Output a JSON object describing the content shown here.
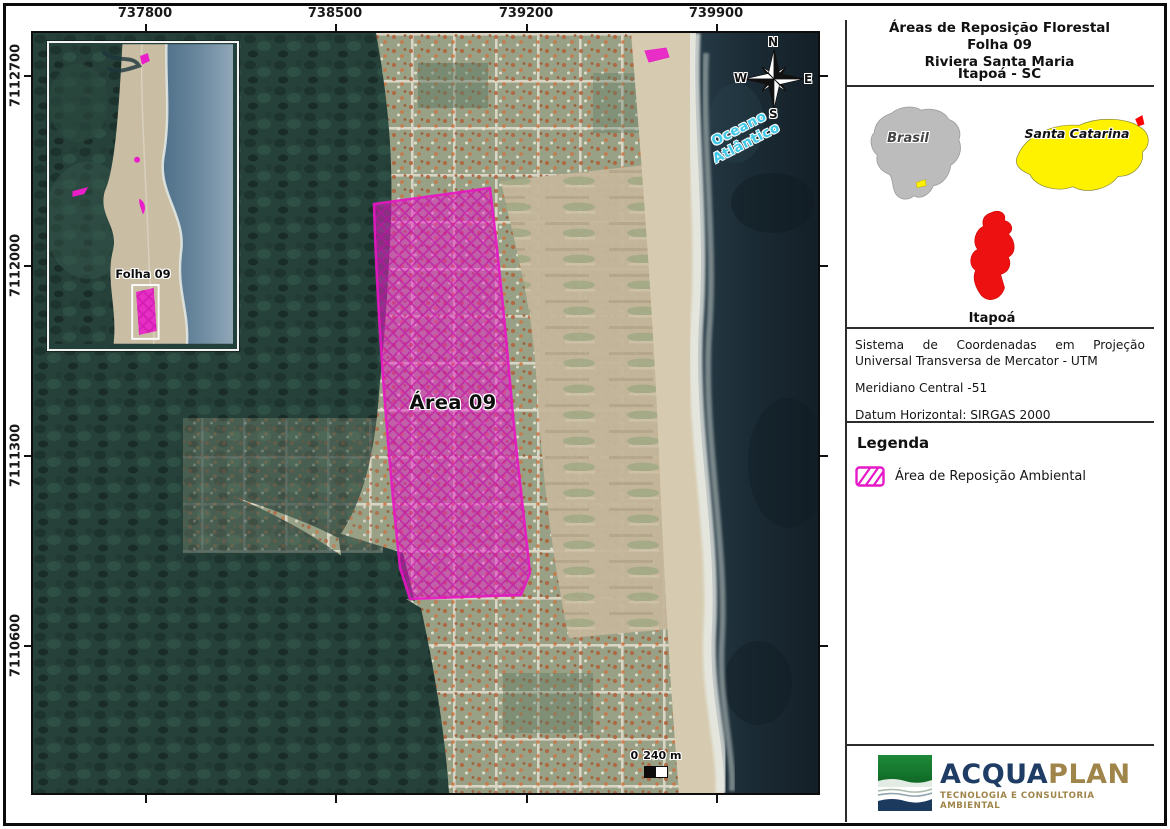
{
  "sheet": {
    "map": {
      "area_label": "Área 09",
      "ocean_label_line1": "Oceano",
      "ocean_label_line2": "Atlântico",
      "scale_zero": "0",
      "scale_text": "240 m",
      "inset_label": "Folha 09",
      "compass": {
        "n": "N",
        "e": "E",
        "s": "S",
        "w": "W"
      },
      "x_ticks": [
        "737800",
        "738500",
        "739200",
        "739900"
      ],
      "y_ticks": [
        "7112700",
        "7112000",
        "7111300",
        "7110600"
      ]
    },
    "panel": {
      "title_line1": "Áreas de Reposição Florestal",
      "title_line2": "Folha 09",
      "title_line3": "Riviera Santa Maria",
      "subtitle": "Itapoá - SC",
      "locator": {
        "country": "Brasil",
        "state": "Santa Catarina",
        "city": "Itapoá"
      },
      "projection_line1": "Sistema de Coordenadas em Projeção Universal Transversa de Mercator - UTM",
      "projection_line2": "Meridiano Central -51",
      "projection_line3": "Datum Horizontal: SIRGAS 2000",
      "legend_title": "Legenda",
      "legend_item": "Área de Reposição Ambiental",
      "logo_acqua": "ACQUA",
      "logo_plan": "PLAN",
      "logo_tagline": "TECNOLOGIA E CONSULTORIA AMBIENTAL"
    },
    "colors": {
      "reposition_area": "#E619C9",
      "state_highlight": "#FFF200",
      "city_highlight": "#FF0000",
      "ocean_label": "#3FC8E8",
      "logo_green": "#157A2E",
      "logo_navy": "#1E3C64",
      "logo_gold": "#A0854A"
    }
  }
}
